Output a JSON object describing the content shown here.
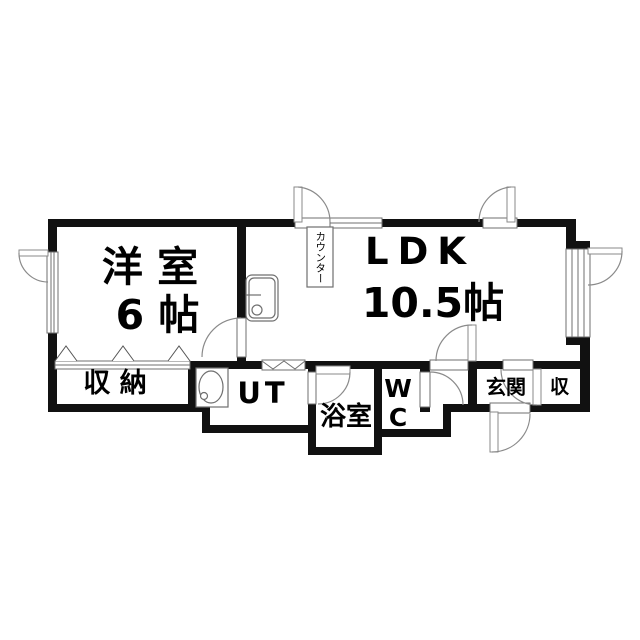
{
  "plan": {
    "rooms": {
      "western_room": {
        "label": "洋 室",
        "size": "6 帖"
      },
      "ldk": {
        "label": "LDK",
        "size": "10.5帖"
      },
      "closet": {
        "label": "収 納"
      },
      "utility": {
        "label": "UT"
      },
      "bathroom": {
        "label": "浴室"
      },
      "toilet": {
        "label": "WC"
      },
      "entrance": {
        "label": "玄関"
      },
      "shoe_cabinet": {
        "label": "収"
      },
      "counter": {
        "label": "カウンター"
      }
    },
    "colors": {
      "wall": "#111111",
      "background": "#ffffff",
      "door_line": "#8a8a8a",
      "fixture_line": "#6f6f6f"
    }
  }
}
